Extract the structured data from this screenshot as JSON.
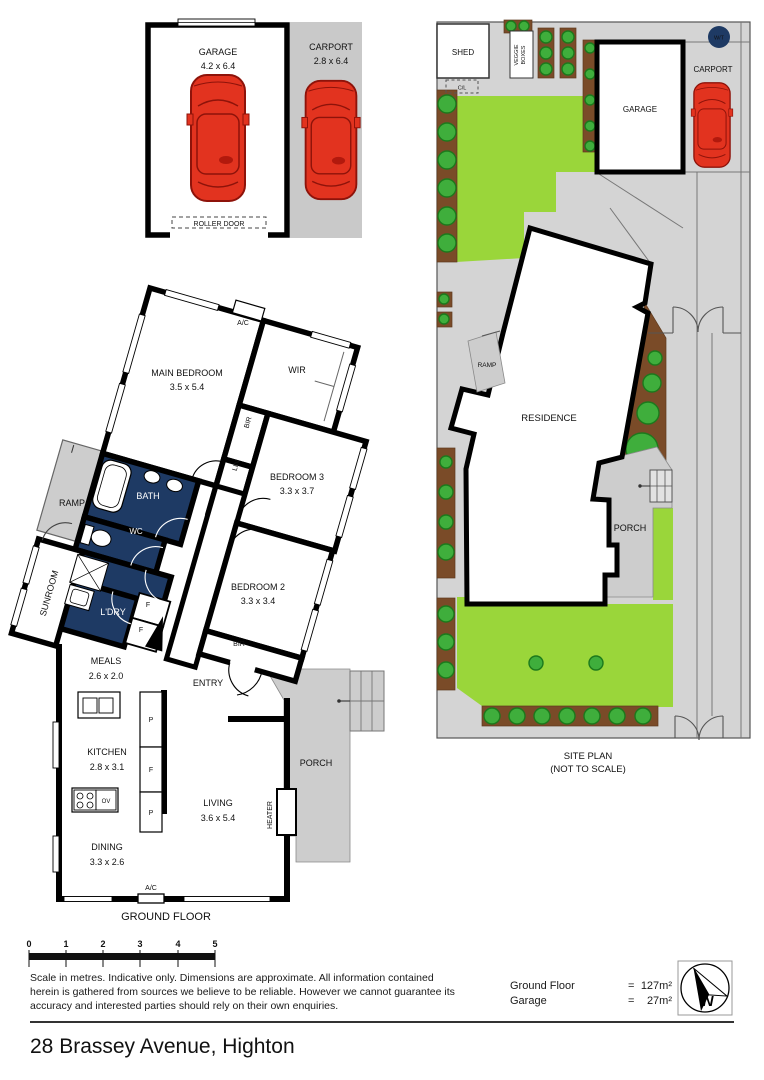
{
  "palette": {
    "wall_black": "#000000",
    "wet_room_navy": "#1e3a64",
    "site_gray": "#d4d4d4",
    "porch_gray": "#cdcdcd",
    "lawn_green": "#9ad63a",
    "tree_green": "#3fae3c",
    "garden_brown": "#7a4b28",
    "car_red": "#e2331f"
  },
  "garage_plan": {
    "garage_label": "GARAGE",
    "garage_dims": "4.2 x 6.4",
    "carport_label": "CARPORT",
    "carport_dims": "2.8 x 6.4",
    "roller_door_label": "ROLLER DOOR"
  },
  "floor_plan": {
    "title": "GROUND FLOOR",
    "main_bedroom": "MAIN BEDROOM",
    "main_bedroom_dims": "3.5 x 5.4",
    "wir": "WIR",
    "bir": "BIR",
    "lin": "LIN",
    "bedroom3": "BEDROOM 3",
    "bedroom3_dims": "3.3 x 3.7",
    "bedroom2": "BEDROOM 2",
    "bedroom2_dims": "3.3 x 3.4",
    "bedroom2_bir": "BIR",
    "bath": "BATH",
    "wc": "WC",
    "laundry": "L'DRY",
    "cupboard_f1": "F",
    "cupboard_f2": "F",
    "ramp": "RAMP",
    "sunroom": "SUNROOM",
    "ac_top": "A/C",
    "ac_bottom": "A/C",
    "meals": "MEALS",
    "meals_dims": "2.6 x 2.0",
    "kitchen": "KITCHEN",
    "kitchen_dims": "2.8 x 3.1",
    "dining": "DINING",
    "dining_dims": "3.3 x 2.6",
    "living": "LIVING",
    "living_dims": "3.6 x 5.4",
    "entry": "ENTRY",
    "porch": "PORCH",
    "heater": "HEATER",
    "oven": "OV",
    "pantry_p1": "P",
    "pantry_f": "F",
    "pantry_p2": "P"
  },
  "site_plan": {
    "shed": "SHED",
    "clothesline": "C/L",
    "veggie_line1": "VEGGIE",
    "veggie_line2": "BOXES",
    "garage": "GARAGE",
    "carport": "CARPORT",
    "water_tank": "W/T",
    "ramp": "RAMP",
    "residence": "RESIDENCE",
    "porch": "PORCH",
    "caption_line1": "SITE PLAN",
    "caption_line2": "(NOT TO SCALE)"
  },
  "scale_bar": {
    "ticks": [
      "0",
      "1",
      "2",
      "3",
      "4",
      "5"
    ]
  },
  "disclaimer": [
    "Scale in metres. Indicative only. Dimensions are approximate. All information contained",
    "herein is gathered from sources we believe to be reliable. However we cannot guarantee its",
    "accuracy and interested parties should rely on their own enquiries."
  ],
  "areas": {
    "ground_floor_label": "Ground Floor",
    "ground_floor_eq": "=",
    "ground_floor_value": "127m²",
    "garage_label": "Garage",
    "garage_eq": "=",
    "garage_value": "27m²"
  },
  "compass": {
    "north": "N"
  },
  "address": "28 Brassey Avenue, Highton"
}
